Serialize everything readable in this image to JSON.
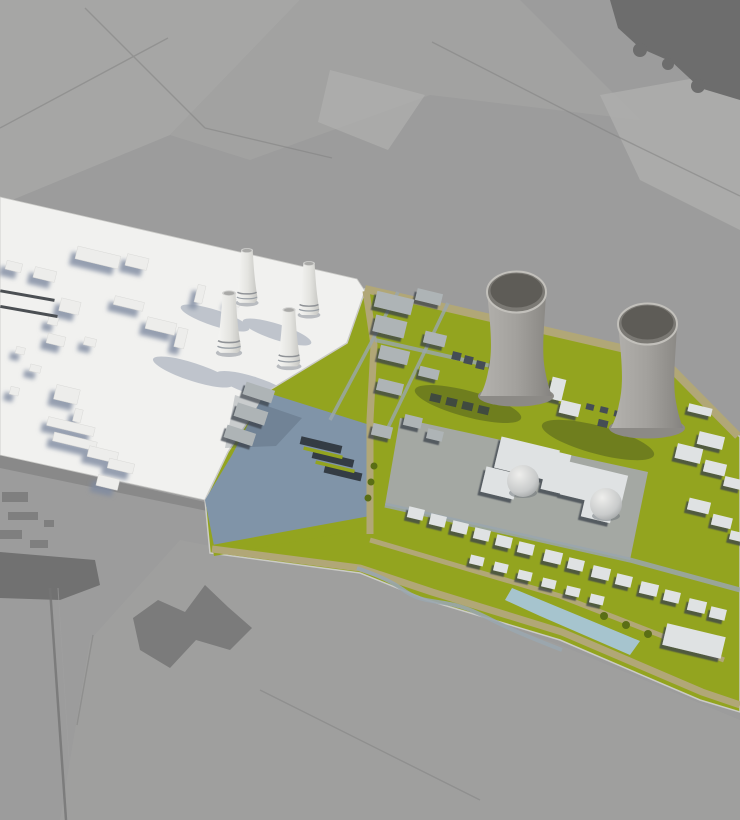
{
  "scene": {
    "title": "Aerial 3D visualization of a nuclear power plant site",
    "media_type": "photorealistic composite render; no text or UI controls visible",
    "background": "grayscale aerial farmland with field boundaries, rural roads, wooded patches and a village trace",
    "existing_plant_model": {
      "style": "white massing model",
      "cooling_towers_count": 4,
      "features": [
        "low industrial halls",
        "four small hyperboloid cooling towers",
        "long soft blue-gray shadows cast to lower-left"
      ]
    },
    "new_plant_model": {
      "style": "full-color site model",
      "cooling_towers_count": 2,
      "containment_domes_count": 2,
      "features": [
        "green landscaped site",
        "khaki perimeter roads",
        "gray warehouses and service buildings",
        "blue-gray parking apron with car rows",
        "light-blue retention pond",
        "two large hyperboloid cooling towers"
      ]
    }
  },
  "counts": {
    "small_cooling_towers": 4,
    "large_cooling_towers": 2,
    "reactor_domes": 2
  },
  "colors": {
    "terrain_base": "#9c9c9c",
    "terrain_light": "#a9a9a8",
    "terrain_dark": "#6d6d6d",
    "white_model": "#f1f1ef",
    "model_shadow_blue": "#8e99ab",
    "grass": "#93a41f",
    "grass_dark": "#5a6e15",
    "road_khaki": "#b1a777",
    "road_gray": "#9aa6ae",
    "pad_gray": "#a4a9ab",
    "parking_blue": "#8094a8",
    "water_light": "#a7c6d8",
    "building_top": "#dfe2e3",
    "building_mid": "#aeb4b6",
    "building_dark": "#454d55",
    "tower_concrete": "#a3a19d"
  }
}
